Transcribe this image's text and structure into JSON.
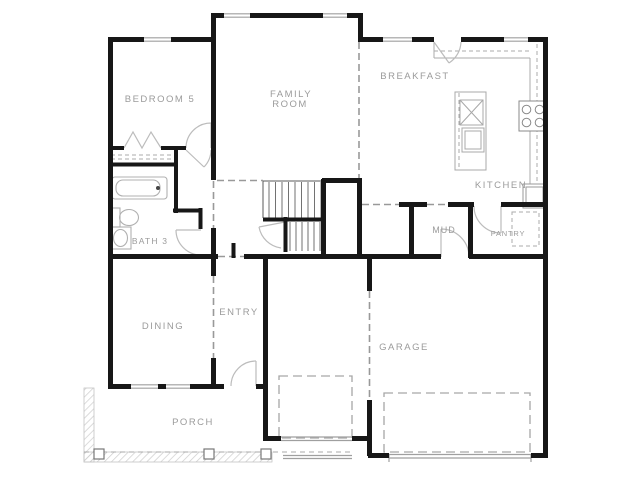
{
  "figure": {
    "type": "floor-plan",
    "description": "Single-family home first floor plan"
  },
  "rooms": {
    "bedroom5": "BEDROOM 5",
    "family_line1": "FAMILY",
    "family_line2": "ROOM",
    "breakfast": "BREAKFAST",
    "kitchen": "KITCHEN",
    "mud": "MUD",
    "pantry": "PANTRY",
    "entry": "ENTRY",
    "dining": "DINING",
    "garage": "GARAGE",
    "porch": "PORCH",
    "bath3": "BATH 3"
  },
  "colors": {
    "background": "#ffffff",
    "wall": "#171717",
    "room_label": "#9b9b9b",
    "fixture_line": "#b0b0b0",
    "window_line": "#9f9f9f",
    "dashed_opening": "#999999",
    "porch_hatch": "#cccccc"
  }
}
